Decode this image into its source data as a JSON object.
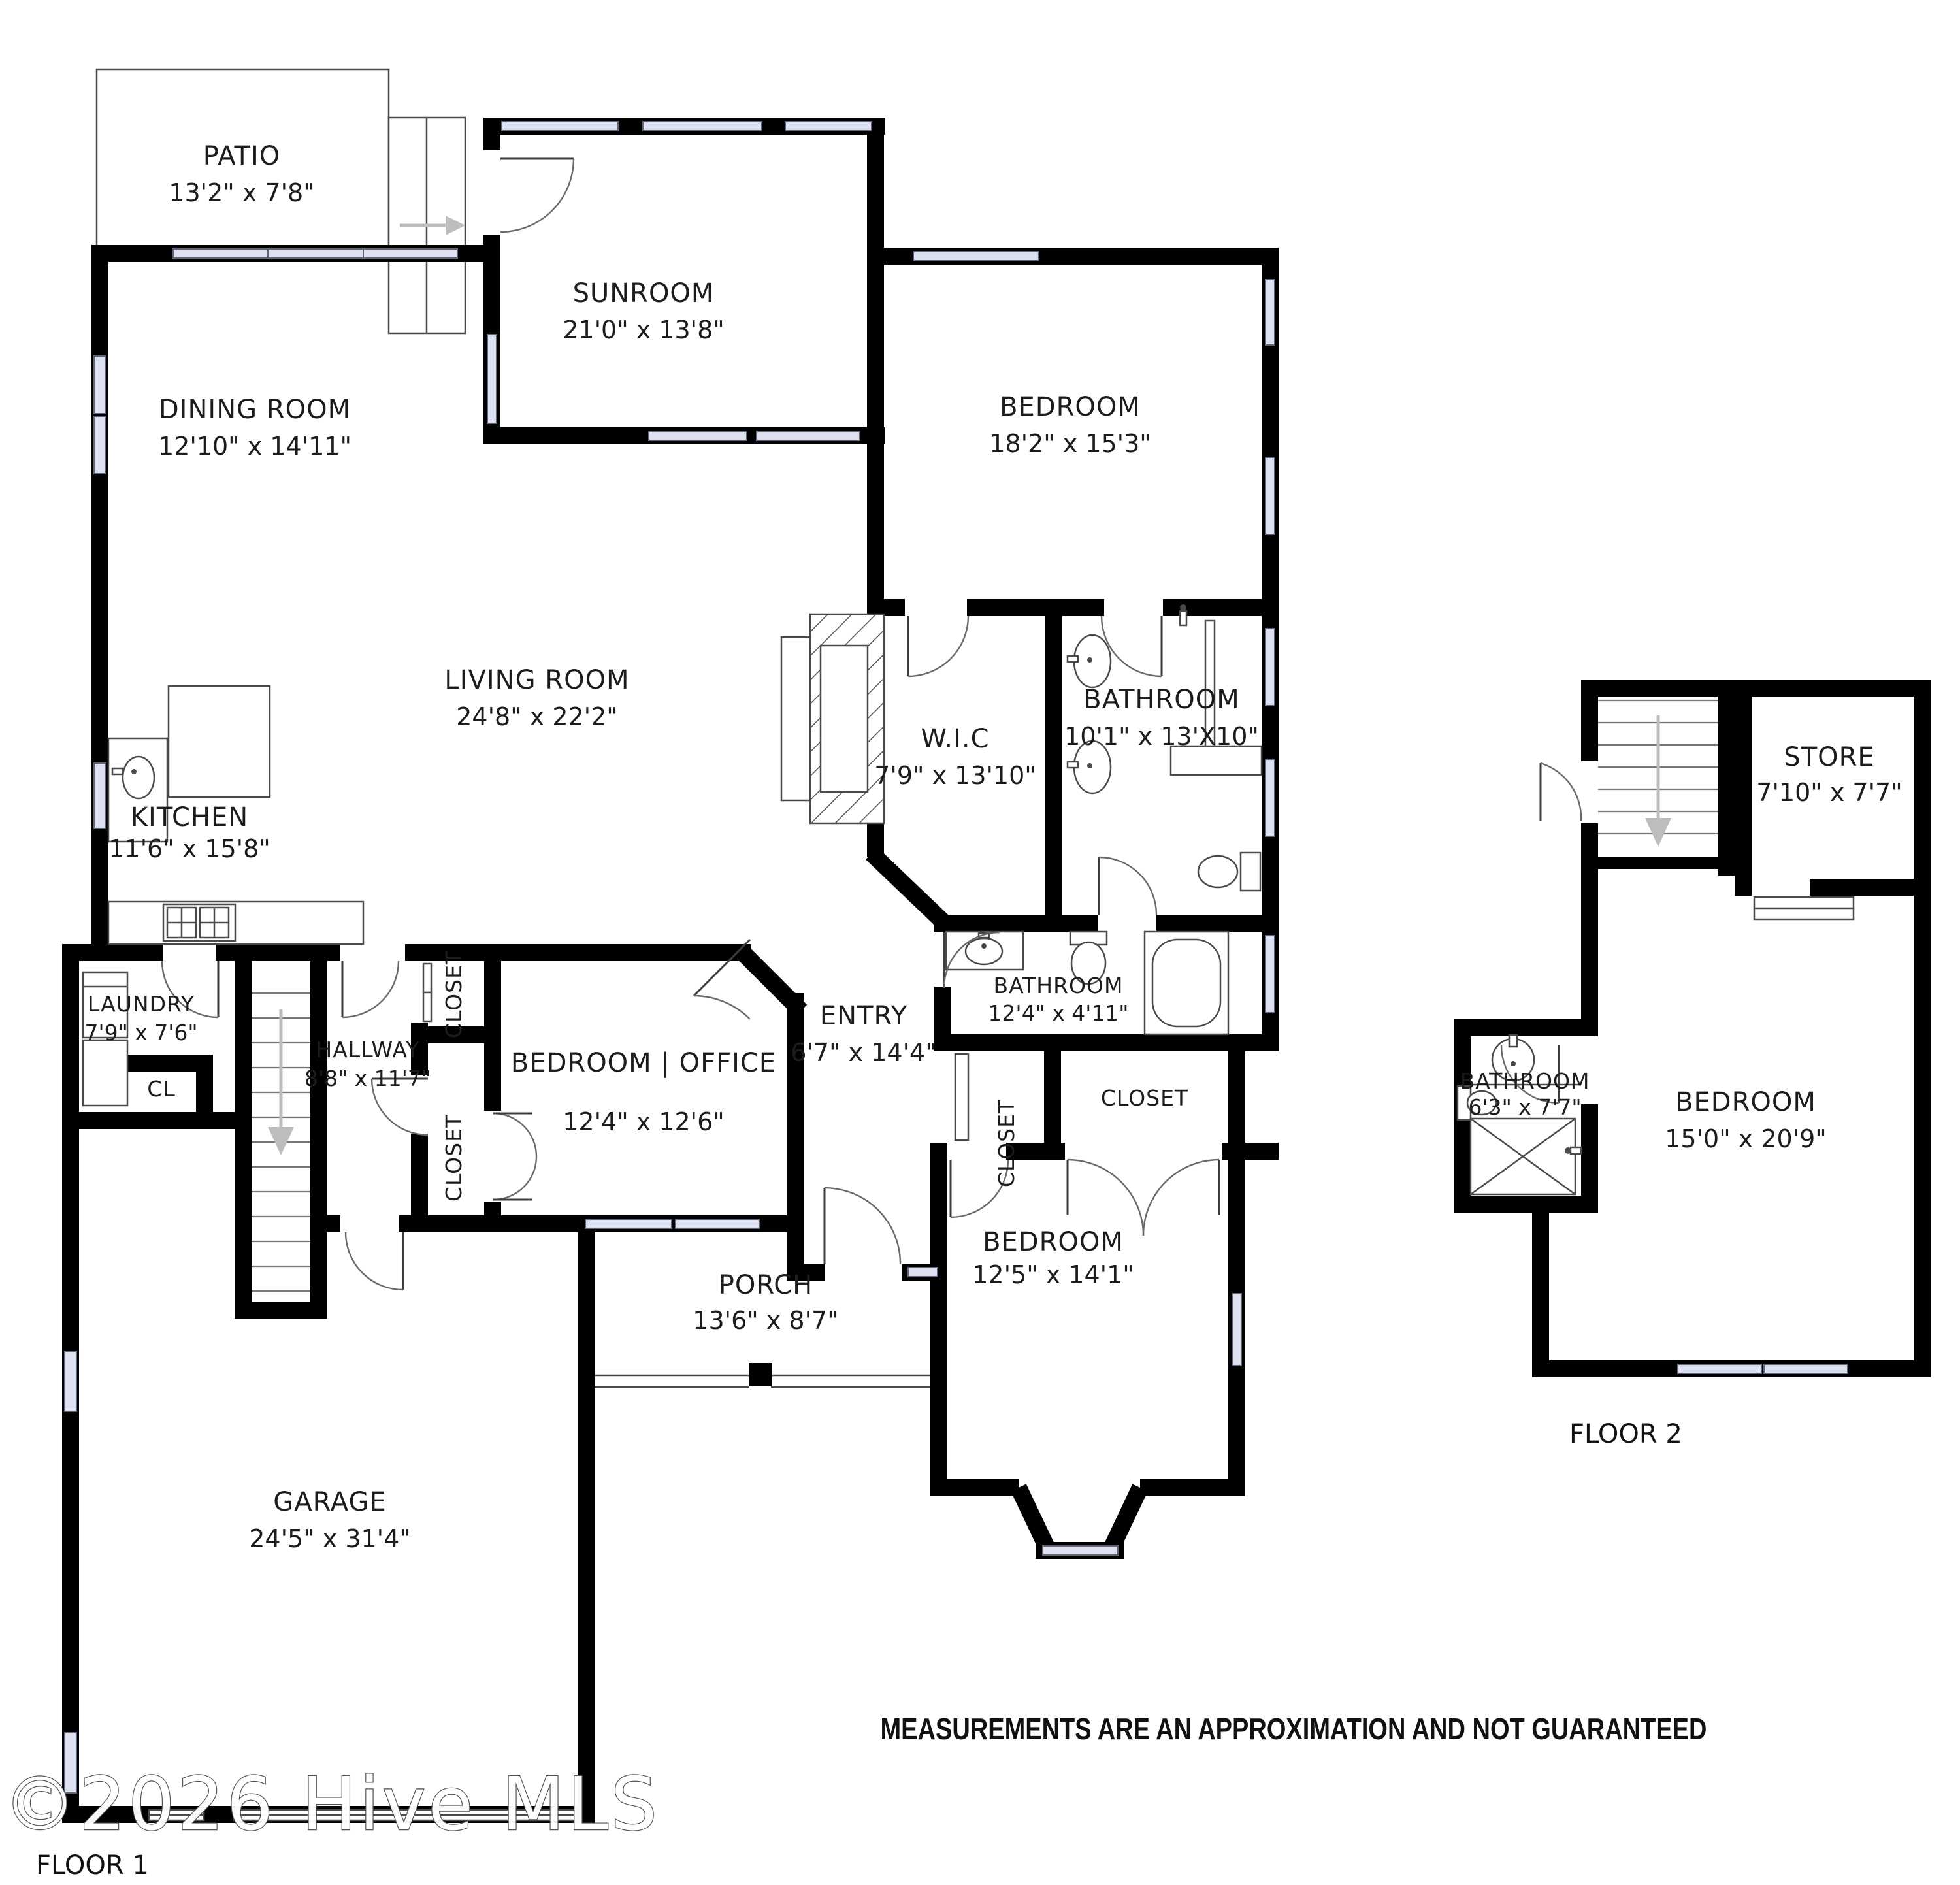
{
  "meta": {
    "floor1_label": "FLOOR 1",
    "floor2_label": "FLOOR 2",
    "disclaimer": "MEASUREMENTS ARE AN APPROXIMATION AND NOT GUARANTEED",
    "watermark": "©2026 Hive MLS"
  },
  "floor1": {
    "rooms": {
      "patio": {
        "name": "PATIO",
        "dims": "13'2\" x 7'8\""
      },
      "sunroom": {
        "name": "SUNROOM",
        "dims": "21'0\" x 13'8\""
      },
      "dining": {
        "name": "DINING ROOM",
        "dims": "12'10\" x 14'11\""
      },
      "bedroom_top": {
        "name": "BEDROOM",
        "dims": "18'2\" x 15'3\""
      },
      "living": {
        "name": "LIVING ROOM",
        "dims": "24'8\" x 22'2\""
      },
      "wic": {
        "name": "W.I.C",
        "dims": "7'9\" x 13'10\""
      },
      "bathroom_master": {
        "name": "BATHROOM",
        "dims": "10'1\" x 13'X10\""
      },
      "kitchen": {
        "name": "KITCHEN",
        "dims": "11'6\" x 15'8\""
      },
      "laundry": {
        "name": "LAUNDRY",
        "dims": "7'9\" x 7'6\""
      },
      "cl": {
        "name": "CL"
      },
      "hallway": {
        "name": "HALLWAY",
        "dims": "8'8\" x 11'7\""
      },
      "closet_hall_top": {
        "name": "CLOSET"
      },
      "closet_hall_bottom": {
        "name": "CLOSET"
      },
      "bedroom_office": {
        "name": "BEDROOM | OFFICE",
        "dims": "12'4\" x 12'6\""
      },
      "entry": {
        "name": "ENTRY",
        "dims": "6'7\" x 14'4\""
      },
      "bathroom_entry": {
        "name": "BATHROOM",
        "dims": "12'4\" x 4'11\""
      },
      "closet_small": {
        "name": "CLOSET"
      },
      "closet_large": {
        "name": "CLOSET"
      },
      "bedroom_front": {
        "name": "BEDROOM",
        "dims": "12'5\" x 14'1\""
      },
      "porch": {
        "name": "PORCH",
        "dims": "13'6\" x 8'7\""
      },
      "garage": {
        "name": "GARAGE",
        "dims": "24'5\" x 31'4\""
      }
    }
  },
  "floor2": {
    "rooms": {
      "store": {
        "name": "STORE",
        "dims": "7'10\" x 7'7\""
      },
      "bathroom": {
        "name": "BATHROOM",
        "dims": "6'3\" x 7'7\""
      },
      "bedroom": {
        "name": "BEDROOM",
        "dims": "15'0\" x 20'9\""
      }
    }
  }
}
